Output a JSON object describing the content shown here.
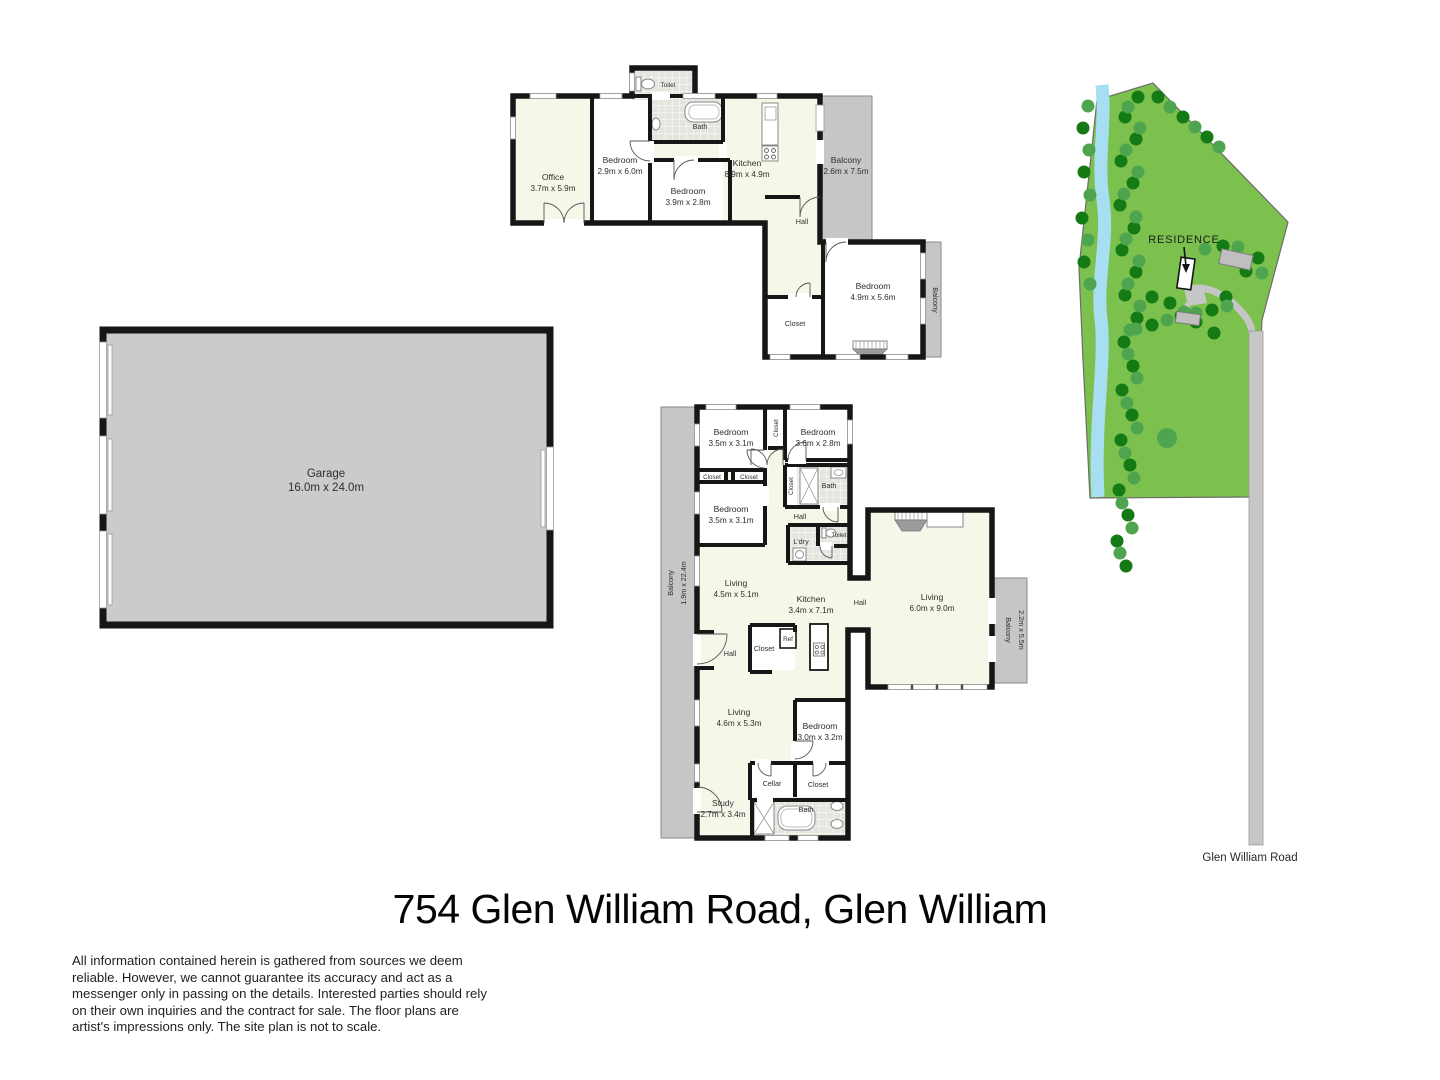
{
  "title": "754 Glen William Road, Glen William",
  "disclaimer": "All information contained herein is gathered from sources we deem reliable. However, we cannot guarantee its accuracy and act as a messenger only in passing on the details. Interested parties should rely on their own inquiries and the contract for sale. The floor plans are artist's impressions only. The site plan is not to scale.",
  "colors": {
    "wall": "#161616",
    "floor_cream": "#F7F7E9",
    "floor_white": "#FFFFFF",
    "tile_base": "#E5E5DF",
    "balcony_gray": "#C6C6C6",
    "garage_gray": "#CBCBCB",
    "site_green": "#7CC14E",
    "tree_dark": "#147A14",
    "tree_light": "#4FA54F",
    "creek_blue": "#A8DEF2",
    "road_gray": "#C6C6C6"
  },
  "upper": {
    "toilet": "Toilet",
    "bath": "Bath",
    "office": {
      "name": "Office",
      "dims": "3.7m x 5.9m"
    },
    "bed1": {
      "name": "Bedroom",
      "dims": "2.9m x 6.0m"
    },
    "bed2": {
      "name": "Bedroom",
      "dims": "3.9m x 2.8m"
    },
    "kitchen": {
      "name": "Kitchen",
      "dims": "8.9m x 4.9m"
    },
    "balcony1": {
      "name": "Balcony",
      "dims": "2.6m x 7.5m"
    },
    "hall": "Hall",
    "bed3": {
      "name": "Bedroom",
      "dims": "4.9m x 5.6m"
    },
    "closet": "Closet",
    "balcony2": "Balcony"
  },
  "garage": {
    "name": "Garage",
    "dims": "16.0m x 24.0m"
  },
  "lower": {
    "bedT1": {
      "name": "Bedroom",
      "dims": "3.5m x 3.1m"
    },
    "closetV1": "Closet",
    "bedT2": {
      "name": "Bedroom",
      "dims": "3.6m x 2.8m"
    },
    "closetS1": "Closet",
    "closetS2": "Closet",
    "bedT3": {
      "name": "Bedroom",
      "dims": "3.5m x 3.1m"
    },
    "closetV2": "Closet",
    "bathT": "Bath",
    "hallT": "Hall",
    "ldry": "L'dry",
    "toilet": "Toilet",
    "living1": {
      "name": "Living",
      "dims": "4.5m x 5.1m"
    },
    "kitchen": {
      "name": "Kitchen",
      "dims": "3.4m x 7.1m"
    },
    "hallM": "Hall",
    "living2": {
      "name": "Living",
      "dims": "6.0m x 9.0m"
    },
    "balconyL": {
      "name": "Balcony",
      "dims": "1.9m x 22.4m"
    },
    "balconyR": {
      "name": "Balcony",
      "dims": "2.2m x 5.5m"
    },
    "hallB": "Hall",
    "closetRef": "Closet",
    "ref": "Ref",
    "living3": {
      "name": "Living",
      "dims": "4.6m x 5.3m"
    },
    "bedB": {
      "name": "Bedroom",
      "dims": "3.0m x 3.2m"
    },
    "cellar": "Cellar",
    "closetB": "Closet",
    "study": {
      "name": "Study",
      "dims": "2.7m x 3.4m"
    },
    "bathB": "Bath"
  },
  "site": {
    "residence": "RESIDENCE",
    "road": "Glen William Road",
    "trees_dark": [
      [
        1138,
        97
      ],
      [
        1125,
        117
      ],
      [
        1136,
        139
      ],
      [
        1121,
        161
      ],
      [
        1133,
        183
      ],
      [
        1120,
        205
      ],
      [
        1134,
        228
      ],
      [
        1122,
        250
      ],
      [
        1136,
        272
      ],
      [
        1125,
        295
      ],
      [
        1137,
        318
      ],
      [
        1124,
        342
      ],
      [
        1133,
        366
      ],
      [
        1122,
        390
      ],
      [
        1132,
        415
      ],
      [
        1121,
        440
      ],
      [
        1130,
        465
      ],
      [
        1119,
        490
      ],
      [
        1128,
        515
      ],
      [
        1117,
        541
      ],
      [
        1126,
        566
      ],
      [
        1083,
        128
      ],
      [
        1084,
        172
      ],
      [
        1082,
        218
      ],
      [
        1084,
        262
      ],
      [
        1158,
        97
      ],
      [
        1183,
        117
      ],
      [
        1207,
        137
      ],
      [
        1223,
        246
      ],
      [
        1258,
        258
      ],
      [
        1246,
        271
      ],
      [
        1152,
        297
      ],
      [
        1170,
        303
      ],
      [
        1226,
        297
      ],
      [
        1196,
        322
      ],
      [
        1214,
        333
      ],
      [
        1152,
        325
      ],
      [
        1181,
        316
      ],
      [
        1212,
        310
      ]
    ],
    "trees_light": [
      [
        1128,
        107
      ],
      [
        1140,
        128
      ],
      [
        1126,
        150
      ],
      [
        1138,
        172
      ],
      [
        1124,
        194
      ],
      [
        1136,
        217
      ],
      [
        1126,
        239
      ],
      [
        1139,
        261
      ],
      [
        1128,
        284
      ],
      [
        1140,
        306
      ],
      [
        1130,
        330
      ],
      [
        1128,
        354
      ],
      [
        1137,
        378
      ],
      [
        1127,
        403
      ],
      [
        1137,
        428
      ],
      [
        1125,
        453
      ],
      [
        1134,
        478
      ],
      [
        1122,
        503
      ],
      [
        1132,
        528
      ],
      [
        1120,
        553
      ],
      [
        1088,
        106
      ],
      [
        1089,
        150
      ],
      [
        1090,
        195
      ],
      [
        1088,
        240
      ],
      [
        1090,
        284
      ],
      [
        1170,
        107
      ],
      [
        1195,
        127
      ],
      [
        1219,
        147
      ],
      [
        1205,
        249
      ],
      [
        1238,
        247
      ],
      [
        1262,
        273
      ],
      [
        1184,
        312
      ],
      [
        1240,
        262
      ],
      [
        1136,
        329
      ],
      [
        1167,
        320
      ],
      [
        1196,
        313
      ],
      [
        1227,
        306
      ],
      [
        1167,
        438,
        10
      ]
    ]
  }
}
